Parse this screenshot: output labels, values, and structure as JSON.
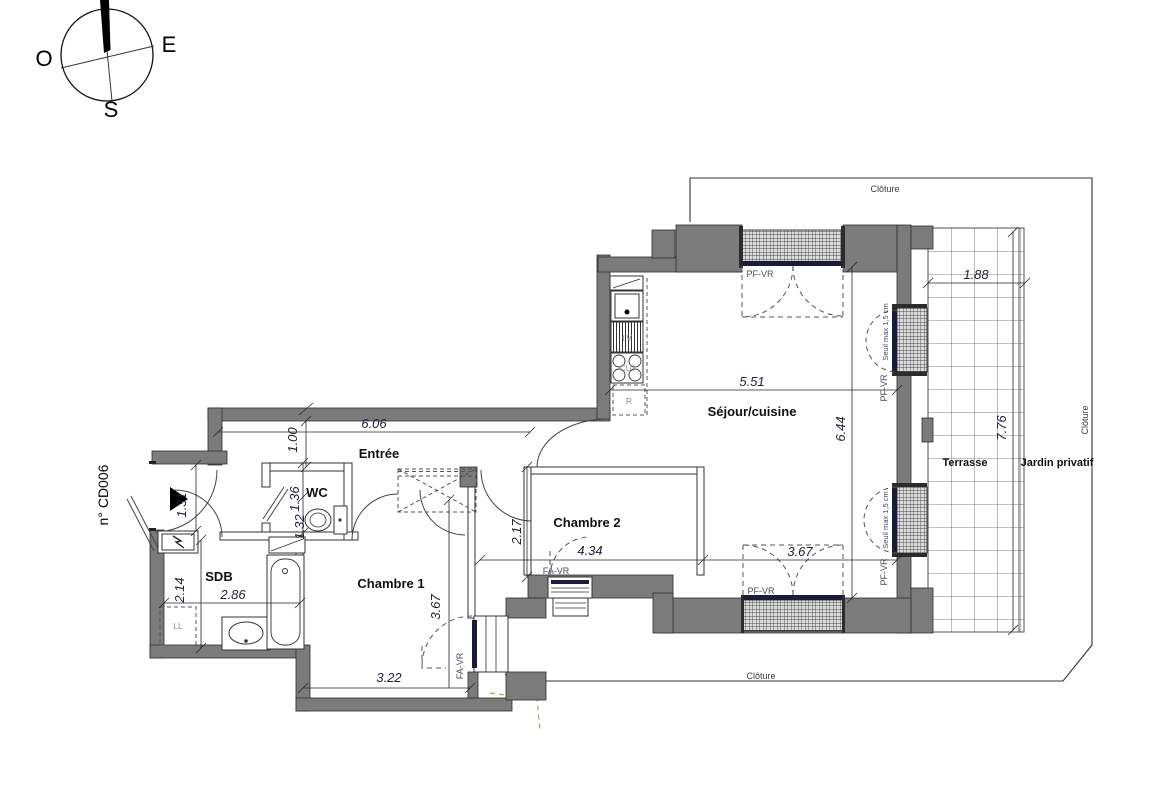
{
  "plan": {
    "unit_number": "n° CD006"
  },
  "compass": {
    "west": "O",
    "east": "E",
    "south": "S"
  },
  "rooms": {
    "entree": "Entrée",
    "wc": "WC",
    "sdb": "SDB",
    "chambre1": "Chambre 1",
    "chambre2": "Chambre 2",
    "sejour": "Séjour/cuisine",
    "terrasse": "Terrasse",
    "jardin": "Jardin privatif"
  },
  "fixtures": {
    "washing_machine": "LL",
    "dishwasher": "LV",
    "cooktop": "CUI",
    "fridge": "R"
  },
  "openings": {
    "pf_vr": "PF-VR",
    "fa_vr": "FA-VR",
    "threshold": "Seuil max 1,5 cm"
  },
  "site": {
    "fence": "Clôture"
  },
  "dims": {
    "entree_len": "6.06",
    "hall_width": "1.00",
    "entry_door": "1.31",
    "wc_len": "1.36",
    "wc_width": "1.32",
    "sdb_depth": "2.14",
    "sdb_len": "2.86",
    "ch1_width": "3.22",
    "ch1_len": "3.67",
    "ch2_depth": "2.17",
    "ch2_len": "4.34",
    "sejour_south": "3.67",
    "sejour_width": "5.51",
    "sejour_len": "6.44",
    "terrasse_width": "1.88",
    "terrasse_len": "7.76"
  }
}
